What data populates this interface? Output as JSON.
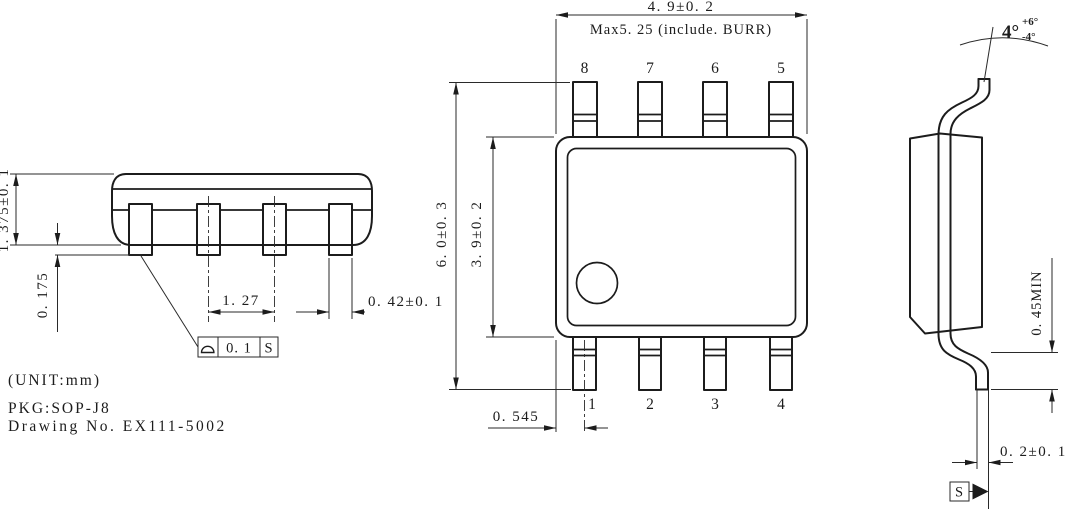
{
  "background": "#ffffff",
  "ink": "#1c1c1c",
  "title_block": {
    "unit": "(UNIT:mm)",
    "package": "PKG:SOP-J8",
    "drawing_no": "Drawing No. EX111-5002"
  },
  "front_view": {
    "dim_height": "1. 375±0. 1",
    "dim_standoff": "0. 175",
    "dim_pitch": "1. 27",
    "dim_lead_width": "0. 42±0. 1",
    "datum_frame": {
      "symbol": "seating-plane",
      "tolerance": "0. 1",
      "datum": "S"
    }
  },
  "plan_view": {
    "dim_body_width": "4. 9±0. 2",
    "note_max_width": "Max5. 25 (include. BURR)",
    "dim_overall_length": "6. 0±0. 3",
    "dim_body_length": "3. 9±0. 2",
    "dim_edge_to_pin1": "0. 545",
    "pins_top": [
      "8",
      "7",
      "6",
      "5"
    ],
    "pins_bottom": [
      "1",
      "2",
      "3",
      "4"
    ]
  },
  "side_view": {
    "lead_angle": "4°",
    "lead_angle_plus": "+6°",
    "lead_angle_minus": "-4°",
    "dim_foot_min": "0. 45MIN",
    "dim_lead_thickness": "0. 2±0. 1",
    "datum": "S"
  }
}
